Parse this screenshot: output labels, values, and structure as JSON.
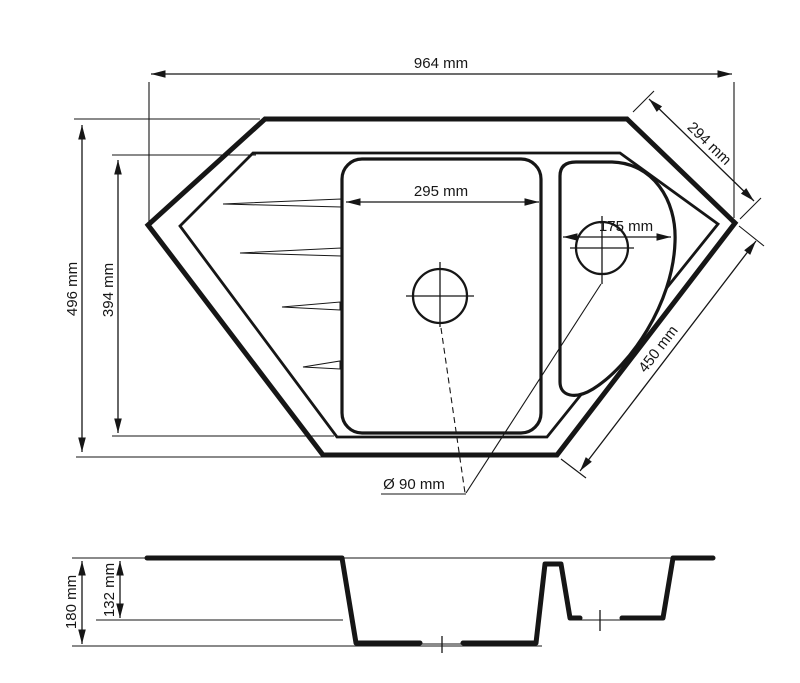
{
  "page": {
    "background": "#ffffff",
    "line_color": "#161616"
  },
  "top_view": {
    "dim_overall_width": "964 mm",
    "dim_overall_depth": "496 mm",
    "dim_inner_depth": "394 mm",
    "dim_main_bowl_width": "295 mm",
    "dim_small_bowl_width": "175 mm",
    "dim_upper_right_edge": "294 mm",
    "dim_lower_right_edge": "450 mm",
    "dim_drain_diameter": "Ø 90 mm"
  },
  "section_view": {
    "dim_total_depth": "180 mm",
    "dim_small_bowl_depth": "132 mm"
  }
}
